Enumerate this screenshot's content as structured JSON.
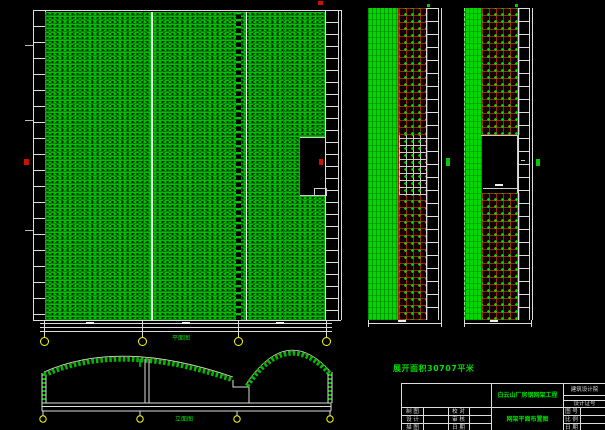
{
  "colors": {
    "background": "#000000",
    "hatch_green": "#00bf00",
    "solid_green": "#00d800",
    "grid_hatch_red": "#9c2a00",
    "line_white": "#dddddd",
    "bubble_yellow": "#ffff00",
    "marker_red": "#cc1100",
    "text_green": "#00dd00"
  },
  "annotations": {
    "area_note": "展开面积30707平米",
    "plan_caption": "平面图",
    "elevation_caption": "立面图"
  },
  "title_block": {
    "project_name": "白云山厂房钢网架工程",
    "drawing_name": "网架平面布置图",
    "org_name": "建筑设计院",
    "cert_label": "设计证号",
    "left_rows": [
      {
        "role": "制 图",
        "check": "校 对"
      },
      {
        "role": "设 计",
        "check": "审 核"
      },
      {
        "role": "描 图",
        "check": "日 期"
      }
    ],
    "right_rows": [
      "图 号",
      "比 例",
      "日 期"
    ]
  }
}
